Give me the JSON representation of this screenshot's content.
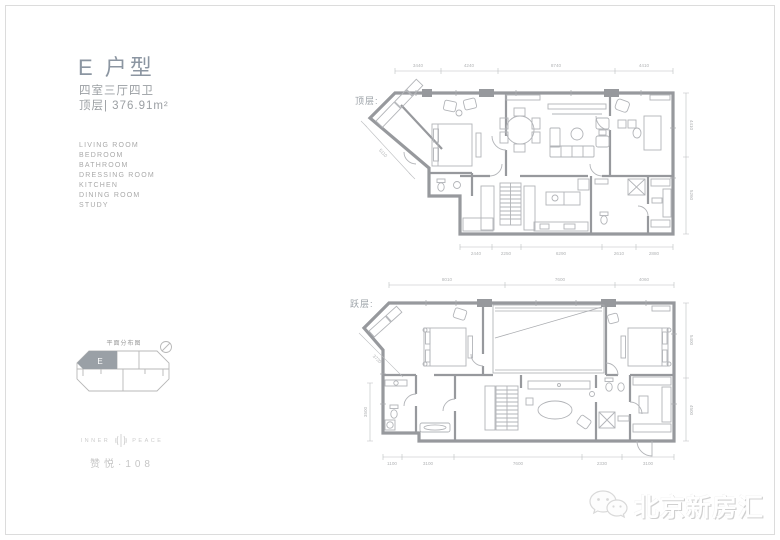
{
  "header": {
    "title": "E 户型",
    "layout": "四室三厅四卫",
    "area": "顶层| 376.91m²"
  },
  "room_list": {
    "items": [
      "LIVING ROOM",
      "BEDROOM",
      "BATHROOM",
      "DRESSING ROOM",
      "KITCHEN",
      "DINING ROOM",
      "STUDY"
    ]
  },
  "key_plan": {
    "title": "平面分布图",
    "unit_label": "E"
  },
  "brand": {
    "english_left": "INNER",
    "english_right": "PEACE",
    "chinese": "赞悦·108"
  },
  "watermark": {
    "text": "北京新房汇",
    "icon": "wechat-icon"
  },
  "plans": {
    "upper": {
      "label": "顶层:",
      "dims_top": [
        "3440",
        "4240",
        "8740",
        "4410"
      ],
      "dims_bottom": [
        "2440",
        "2250",
        "6290",
        "2610",
        "2880"
      ],
      "dims_right": [
        "4410",
        "5260"
      ],
      "dim_diagonal": "5110"
    },
    "lower": {
      "label": "跃层:",
      "dims_top": [
        "8010",
        "7600",
        "4060"
      ],
      "dims_bottom": [
        "1100",
        "3100",
        "7600",
        "2330",
        "3100"
      ],
      "dims_right": [
        "5400",
        "4500"
      ],
      "dims_left": [
        "3500"
      ],
      "dim_diagonal": "3720"
    }
  },
  "colors": {
    "wall": "#97999d",
    "furniture": "#b2b4b8",
    "dimension": "#b2b4b6",
    "title": "#8c96a2",
    "body_text": "#9b9fa3",
    "brand_text": "#c6c6c6",
    "keyplan_unit_fill": "#9aa0a6"
  }
}
